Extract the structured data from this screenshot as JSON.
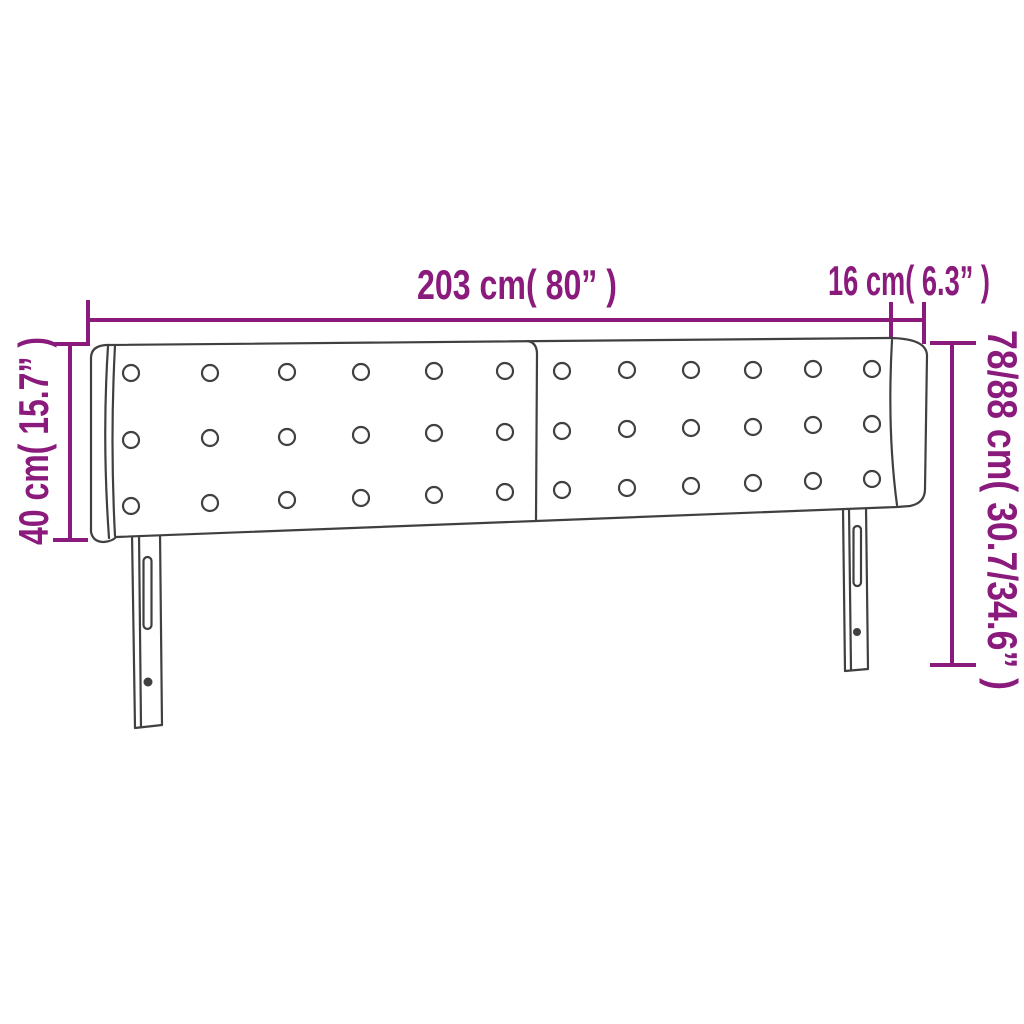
{
  "diagram": {
    "type": "product-dimension-diagram",
    "subject": "upholstered headboard with side wings and two legs",
    "background_color": "#FFFFFF",
    "accent_color": "#8A1B7D",
    "outline_color": "#404040",
    "labels": {
      "width": "203 cm( 80” )",
      "side_depth": "16 cm( 6.3” )",
      "headboard_height": "40 cm( 15.7” )",
      "total_height": "78/88 cm( 30.7/34.6” )"
    },
    "dimensions": [
      {
        "name": "width",
        "cm": "203",
        "inch": "80"
      },
      {
        "name": "side-wing-depth",
        "cm": "16",
        "inch": "6.3"
      },
      {
        "name": "headboard-panel-height",
        "cm": "40",
        "inch": "15.7"
      },
      {
        "name": "total-height-adjustable",
        "cm": "78/88",
        "inch": "30.7/34.6"
      }
    ]
  }
}
